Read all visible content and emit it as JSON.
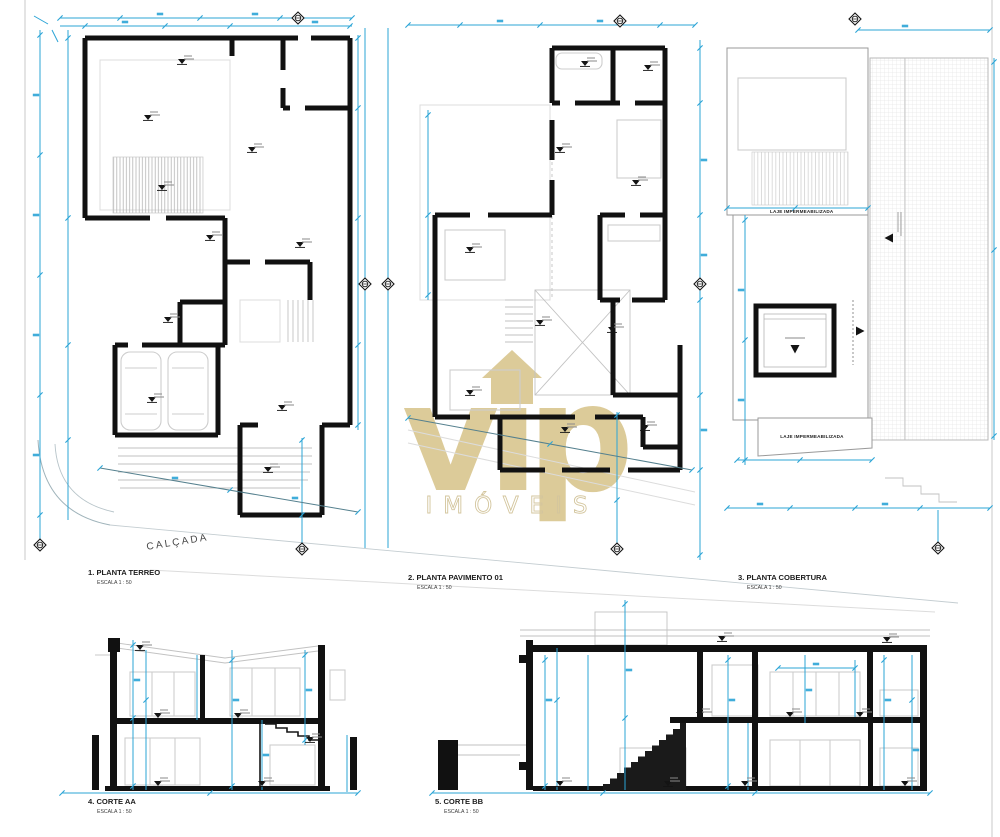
{
  "sheet": {
    "watermark": {
      "brand": "vip",
      "subtitle": "IMÓVEIS"
    },
    "drawings": [
      {
        "title": "1. PLANTA TERREO",
        "scale": "ESCALA 1 : 50"
      },
      {
        "title": "2. PLANTA PAVIMENTO 01",
        "scale": "ESCALA 1 : 50"
      },
      {
        "title": "3. PLANTA COBERTURA",
        "scale": "ESCALA 1 : 50"
      },
      {
        "title": "4. CORTE AA",
        "scale": "ESCALA 1 : 50"
      },
      {
        "title": "5. CORTE BB",
        "scale": "ESCALA 1 : 50"
      }
    ],
    "annotations": {
      "calcada": "CALÇADA",
      "laje_upper": "LAJE IMPERMEABILIZADA",
      "laje_lower": "LAJE IMPERMEABILIZADA"
    },
    "colors": {
      "wall": "#111111",
      "dimension": "#2ba4d6",
      "watermark": "#d7c288",
      "construction": "#d9d9d9"
    }
  }
}
